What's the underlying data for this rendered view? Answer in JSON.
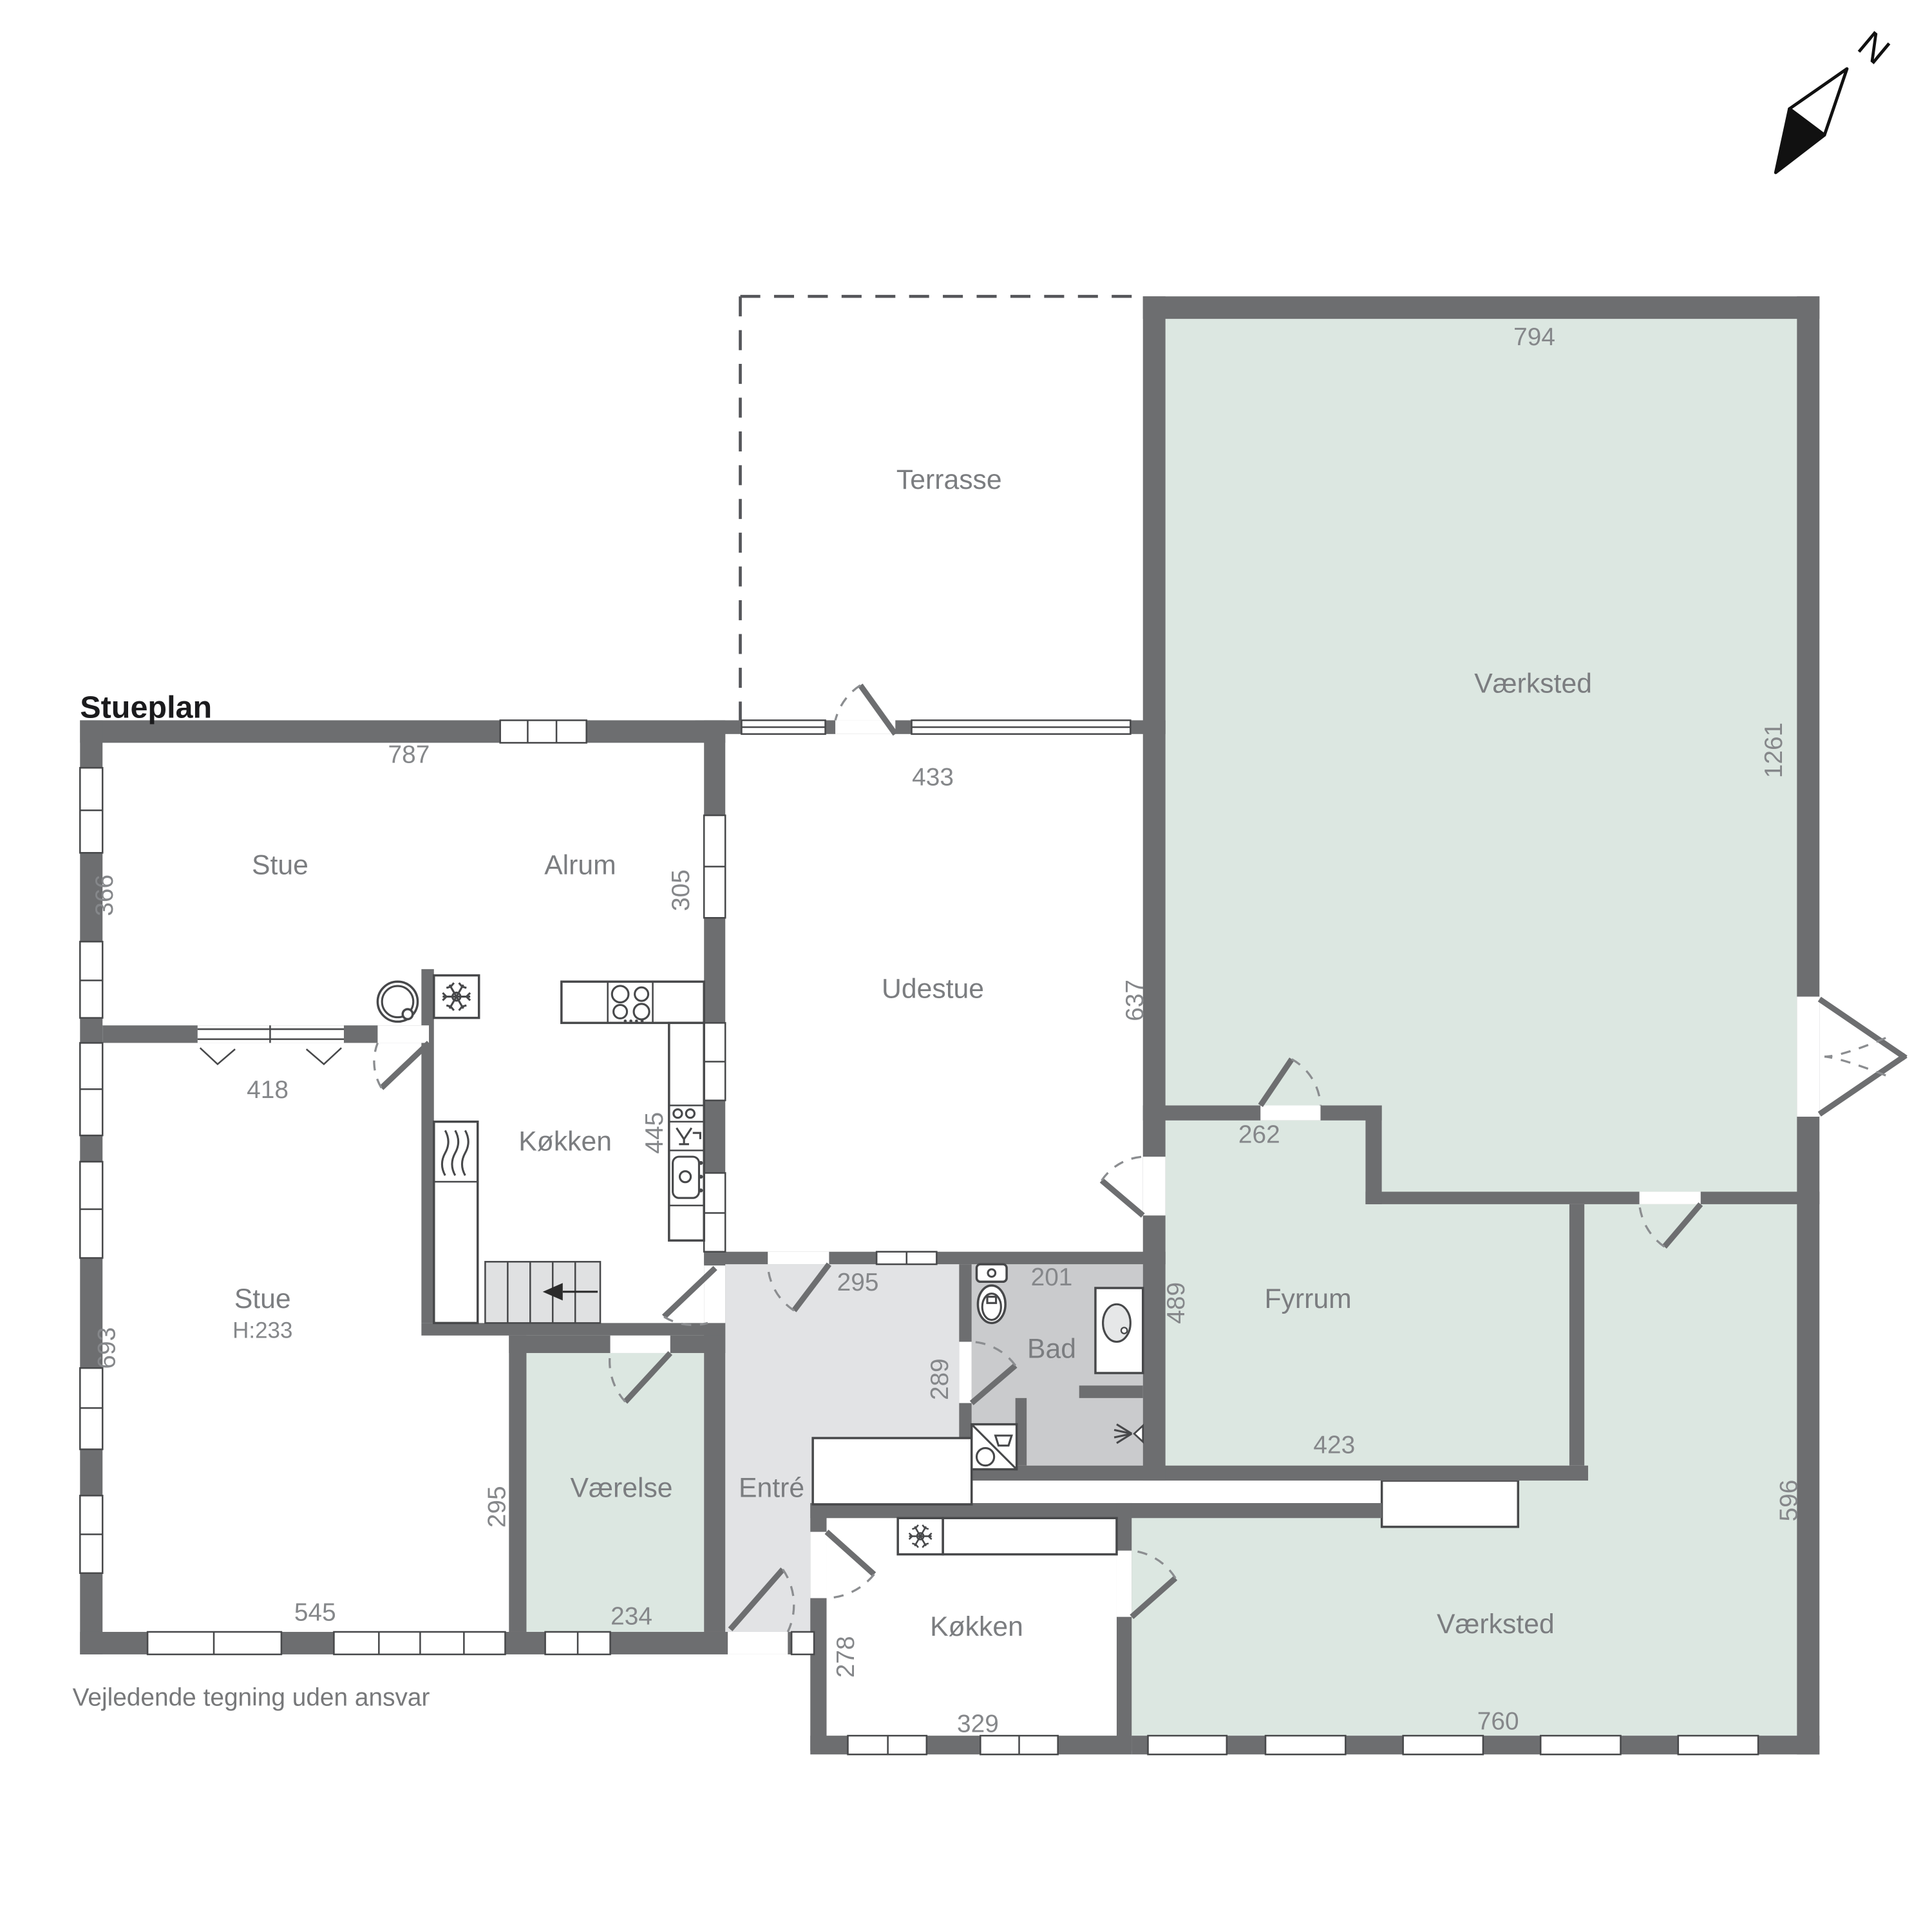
{
  "title": "Stueplan",
  "disclaimer": "Vejledende tegning uden ansvar",
  "compass": {
    "north_label": "N"
  },
  "rooms": {
    "terrasse": {
      "label": "Terrasse"
    },
    "vaerksted_top": {
      "label": "Værksted"
    },
    "stue_top": {
      "label": "Stue"
    },
    "alrum": {
      "label": "Alrum"
    },
    "udestue": {
      "label": "Udestue"
    },
    "koekken": {
      "label": "Køkken"
    },
    "stue_lower": {
      "label": "Stue",
      "ceiling_height": "H:233"
    },
    "vaerelse": {
      "label": "Værelse"
    },
    "entre": {
      "label": "Entré"
    },
    "bad": {
      "label": "Bad"
    },
    "fyrrum": {
      "label": "Fyrrum"
    },
    "koekken_lower": {
      "label": "Køkken"
    },
    "vaerksted_lower": {
      "label": "Værksted"
    }
  },
  "dimensions": {
    "stue_top_width": "787",
    "stue_top_depth": "366",
    "udestue_width": "433",
    "alrum_udestue_wall": "305",
    "vaerksted_top_width": "794",
    "vaerksted_top_depth": "1261",
    "udestue_depth": "637",
    "stue_opening": "418",
    "koekken_counter": "445",
    "stue_lower_depth": "693",
    "stue_lower_width": "545",
    "entre_door": "295",
    "bad_width": "201",
    "entre_depth": "289",
    "fyrrum_top": "262",
    "fyrrum_depth": "489",
    "fyrrum_width": "423",
    "vaerelse_depth": "295",
    "vaerelse_width": "234",
    "koekken_lower_depth": "278",
    "koekken_lower_width": "329",
    "vaerksted_lower_depth": "596",
    "vaerksted_lower_width": "760"
  },
  "colors": {
    "wall": "#6d6e70",
    "room_green": "#dce7e1",
    "bad_gray": "#cacbcd",
    "entre_gray": "#e2e3e5",
    "stairs_gray": "#e0e1e2",
    "label_gray": "#7b7d80",
    "dimension_gray": "#85878a"
  },
  "icons": [
    "north-arrow",
    "freezer-icon",
    "boiler-icon",
    "radiator-icon",
    "stove-icon",
    "dishwasher-icon",
    "kitchen-sink-icon",
    "stairs",
    "toilet-icon",
    "washbasin-icon",
    "shower-icon",
    "washing-machine-icon"
  ]
}
